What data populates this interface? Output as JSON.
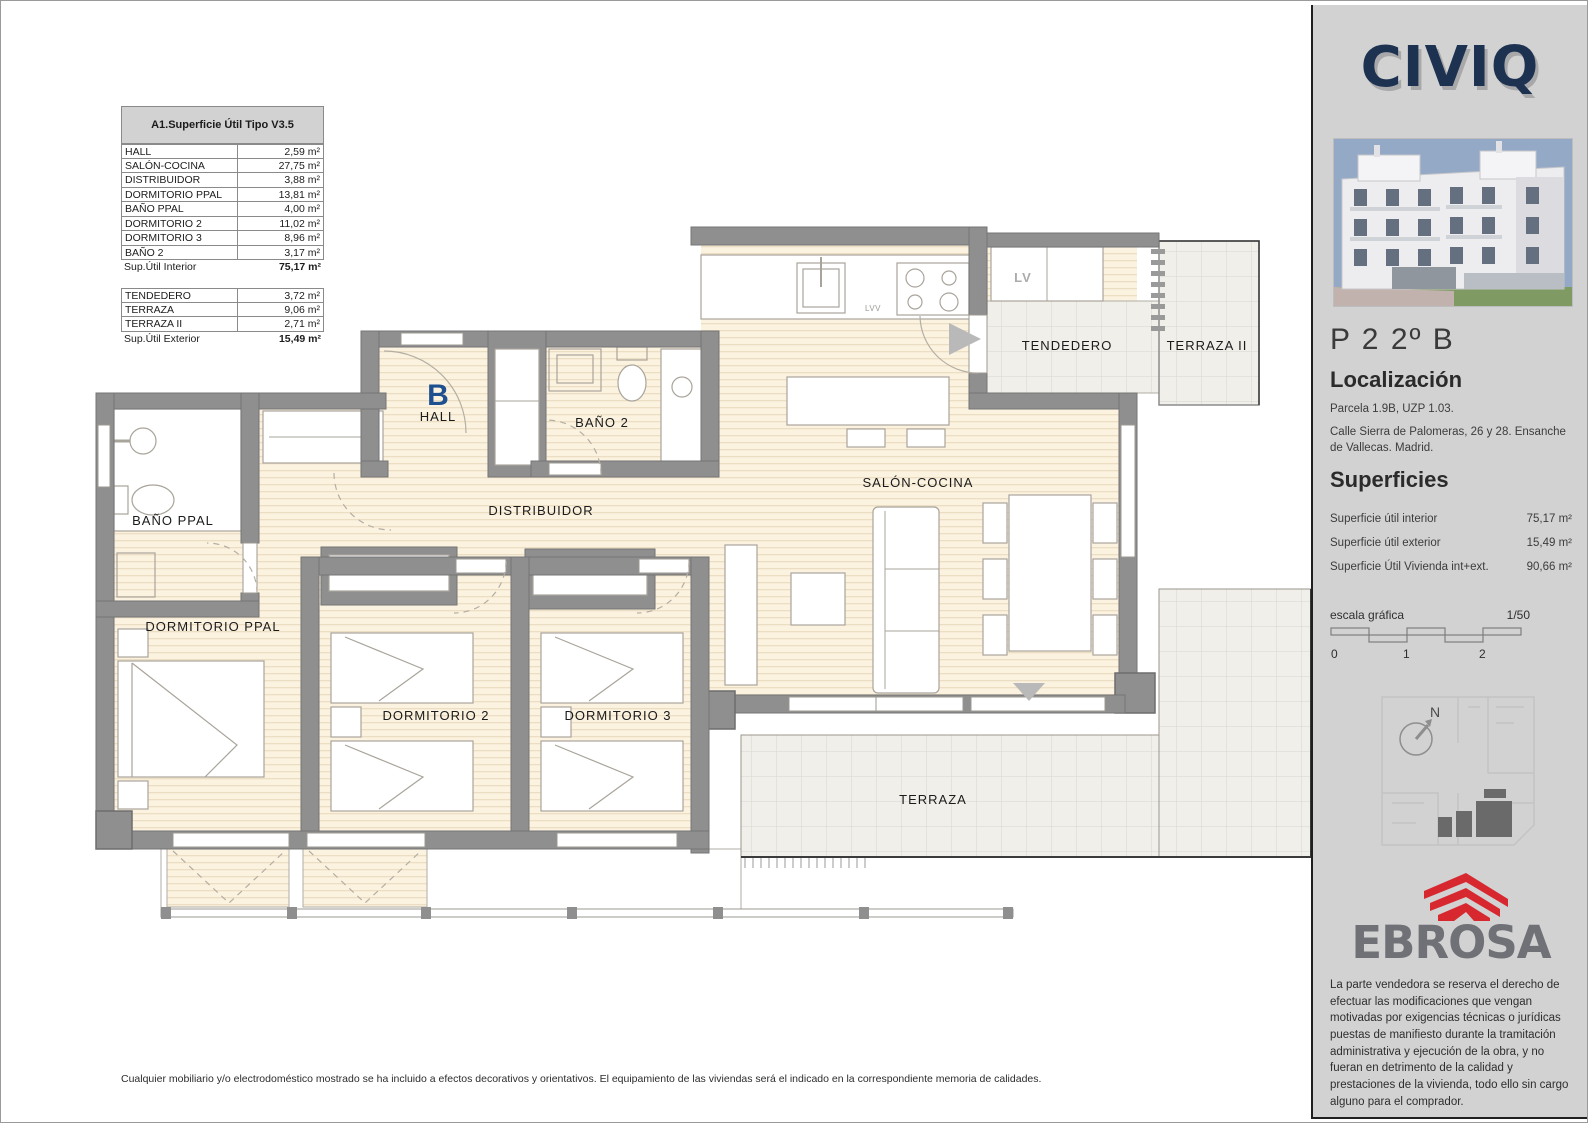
{
  "page": {
    "bottom_note": "Cualquier mobiliario y/o electrodoméstico mostrado se ha incluido a efectos decorativos y orientativos. El equipamiento de las viviendas será el indicado en la correspondiente memoria de calidades."
  },
  "area_table": {
    "title": "A1.Superficie Útil Tipo V3.5",
    "interior_rows": [
      {
        "name": "HALL",
        "value": "2,59 m²"
      },
      {
        "name": "SALÓN-COCINA",
        "value": "27,75 m²"
      },
      {
        "name": "DISTRIBUIDOR",
        "value": "3,88 m²"
      },
      {
        "name": "DORMITORIO PPAL",
        "value": "13,81 m²"
      },
      {
        "name": "BAÑO PPAL",
        "value": "4,00 m²"
      },
      {
        "name": "DORMITORIO 2",
        "value": "11,02 m²"
      },
      {
        "name": "DORMITORIO 3",
        "value": "8,96 m²"
      },
      {
        "name": "BAÑO 2",
        "value": "3,17 m²"
      }
    ],
    "interior_total": {
      "name": "Sup.Útil Interior",
      "value": "75,17 m²"
    },
    "exterior_rows": [
      {
        "name": "TENDEDERO",
        "value": "3,72 m²"
      },
      {
        "name": "TERRAZA",
        "value": "9,06 m²"
      },
      {
        "name": "TERRAZA II",
        "value": "2,71 m²"
      }
    ],
    "exterior_total": {
      "name": "Sup.Útil Exterior",
      "value": "15,49 m²"
    }
  },
  "plan": {
    "unit_letter": "B",
    "rooms": {
      "hall": "HALL",
      "bano2": "BAÑO 2",
      "distribuidor": "DISTRIBUIDOR",
      "bano_ppal": "BAÑO PPAL",
      "dorm_ppal": "DORMITORIO PPAL",
      "dorm2": "DORMITORIO 2",
      "dorm3": "DORMITORIO 3",
      "salon": "SALÓN-COCINA",
      "tendedero": "TENDEDERO",
      "terraza2": "TERRAZA II",
      "terraza": "TERRAZA",
      "lv": "LV",
      "lvv": "LVV"
    }
  },
  "sidebar": {
    "brand": "CIVIQ",
    "unit_title": "P 2  2º B",
    "location_heading": "Localización",
    "location_line1": "Parcela 1.9B, UZP 1.03.",
    "location_line2": "Calle Sierra de Palomeras, 26 y 28. Ensanche de Vallecas. Madrid.",
    "surfaces_heading": "Superficies",
    "surface_rows": [
      {
        "label": "Superficie útil interior",
        "value": "75,17 m²"
      },
      {
        "label": "Superficie útil exterior",
        "value": "15,49 m²"
      },
      {
        "label": "Superficie Útil Vivienda int+ext.",
        "value": "90,66 m²"
      }
    ],
    "scale_label": "escala gráfica",
    "scale_ratio": "1/50",
    "scale_ticks": [
      "0",
      "1",
      "2"
    ],
    "compass_n": "N",
    "developer": "EBROSA",
    "disclaimer": "La parte vendedora se reserva el derecho de efectuar las modificaciones que vengan motivadas por exigencias técnicas o jurídicas puestas de manifiesto durante la tramitación administrativa y ejecución de la obra, y no fueran en detrimento de la calidad y prestaciones de la vivienda, todo ello sin cargo alguno para el comprador."
  },
  "colors": {
    "wall": "#8f8f8f",
    "wood_floor": "#fbf2e0",
    "tile": "#f0efea",
    "brand_navy": "#1d3150",
    "ebrosa_gray": "#707176",
    "ebrosa_red": "#d7282f",
    "unit_letter_blue": "#1e4f8f",
    "sidebar_bg": "#d2d2d2"
  }
}
